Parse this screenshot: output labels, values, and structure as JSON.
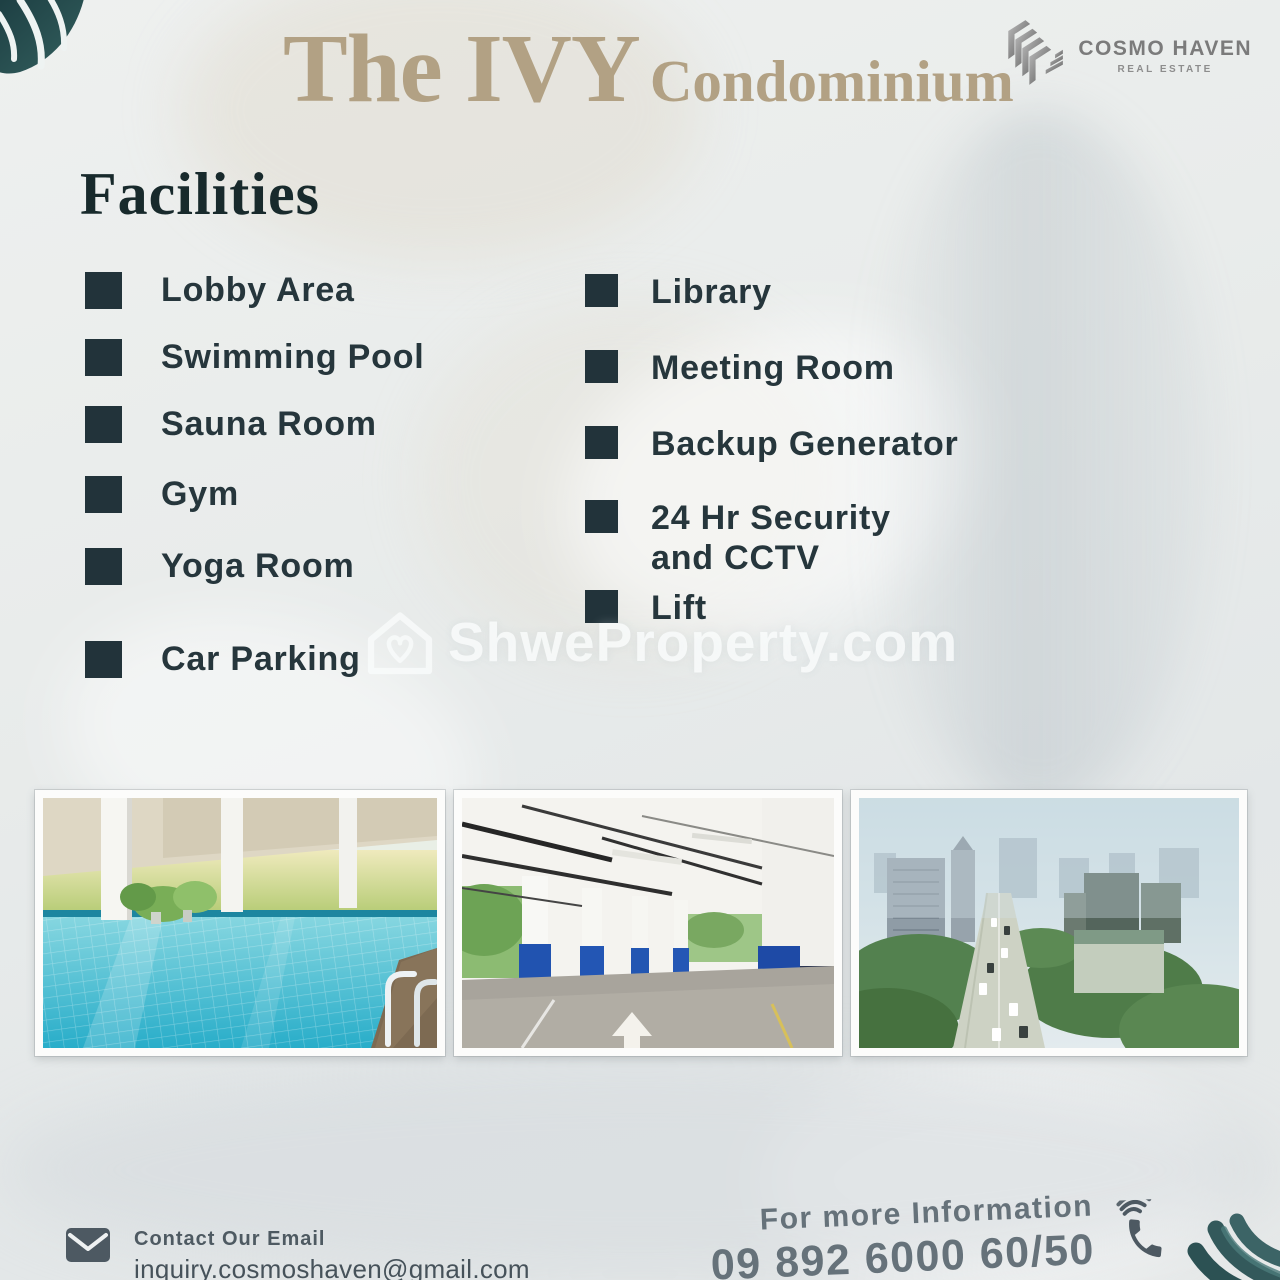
{
  "header": {
    "title_main": "The IVY",
    "title_sub": "Condominium",
    "logo": {
      "name": "COSMO HAVEN",
      "tagline": "REAL ESTATE"
    }
  },
  "facilities": {
    "heading": "Facilities",
    "left": [
      "Lobby Area",
      "Swimming Pool",
      "Sauna Room",
      "Gym",
      "Yoga Room",
      "Car Parking"
    ],
    "right": [
      "Library",
      "Meeting Room",
      "Backup Generator",
      "24 Hr Security and CCTV",
      "Lift"
    ]
  },
  "watermark": {
    "icon": "house-heart-icon",
    "text": "ShweProperty.com"
  },
  "photos": [
    "swimming-pool",
    "car-parking-garage",
    "city-aerial-view"
  ],
  "contact": {
    "email_icon": "envelope-icon",
    "email_label": "Contact Our Email",
    "email": "inquiry.cosmoshaven@gmail.com",
    "phone_label": "For more Information",
    "phone": "09 892 6000 60/50",
    "phone_icon": "phone-handset-icon"
  },
  "colors": {
    "accent_gold": "#b2a184",
    "heading_dark": "#182a2c",
    "list_text": "#26363c",
    "bullet": "#22333a",
    "muted_gray": "#66727a",
    "leaf_teal": "#2e5456",
    "watermark_white": "#f9fcfc",
    "background": "#e9eceb"
  }
}
